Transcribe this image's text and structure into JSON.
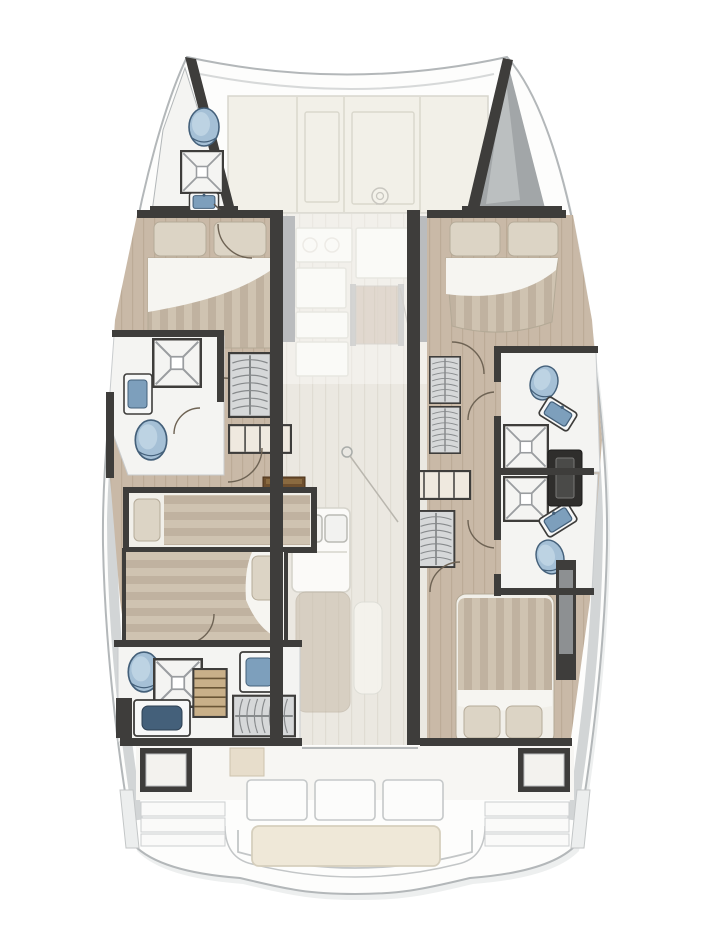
{
  "meta": {
    "type": "floor-plan",
    "subject": "catamaran-yacht-layout-top-view"
  },
  "palette": {
    "hull-line": "#b3b7b9",
    "hull-fill": "#fdfdfc",
    "shadow": "#edefef",
    "band": "#d2d5d6",
    "wall": "#3e3d3b",
    "wall-gray": "#96999b",
    "floor-tan": "#c9b9a7",
    "floor-tan-line": "#bcab97",
    "floor-light": "#ebe8e1",
    "floor-light-line": "#e0dcd3",
    "bath": "#f4f4f2",
    "stripe-a": "#cfc3b1",
    "stripe-b": "#c0b2a0",
    "pillow": "#dcd4c5",
    "pillow-line": "#b5ab99",
    "sheet": "#f6f5f1",
    "cream": "#f2f0e8",
    "cream-line": "#d9d7cc",
    "fixture-blue": "#a5c0d6",
    "fixture-blue-deep": "#7d9fbc",
    "fixture-edge": "#44607a",
    "wardrobe-bg": "#d6d8d9",
    "wardrobe-line": "#878a8c",
    "bench": "#efe8d8",
    "bench-line": "#d6cfbd",
    "door-arc": "#6e6354",
    "wood-dark": "#6e4f2e",
    "ghost-tan": "#c7bcaa",
    "forepeak": "#a2a6a8",
    "steps-tan": "#c9b089",
    "dark-item": "#2f2e2c"
  },
  "regions": {
    "foredeck": {
      "label": "Foredeck lounge"
    },
    "port_bow_head": {
      "label": "Bow bathroom (port)"
    },
    "starboard_bow_locker": {
      "label": "Bow locker (starboard)"
    },
    "port_forward_cabin": {
      "label": "Forward cabin, double berth (port)"
    },
    "starboard_forward_cabin": {
      "label": "Forward cabin, double berth (starboard)"
    },
    "port_mid_bathroom": {
      "label": "Mid bathroom with shower (port)"
    },
    "port_aft_cabin": {
      "label": "Aft cabins, single + double berth (port)"
    },
    "port_aft_bathroom": {
      "label": "Aft bathroom with shower (port)"
    },
    "starboard_forward_bathroom": {
      "label": "Forward bathroom with shower (starboard)"
    },
    "starboard_aft_bathroom": {
      "label": "Aft bathroom with shower (starboard)"
    },
    "starboard_aft_cabin": {
      "label": "Aft cabin, double berth (starboard)"
    },
    "salon": {
      "label": "Salon and galley, main deck (ghosted)"
    },
    "aft_cockpit": {
      "label": "Aft cockpit"
    },
    "transom": {
      "label": "Transom and swim platform"
    }
  },
  "fixtures_observed": {
    "toilets": 5,
    "showers": 5,
    "sinks": 6,
    "double_berths": 4,
    "single_berths": 1,
    "wardrobes": 6
  }
}
